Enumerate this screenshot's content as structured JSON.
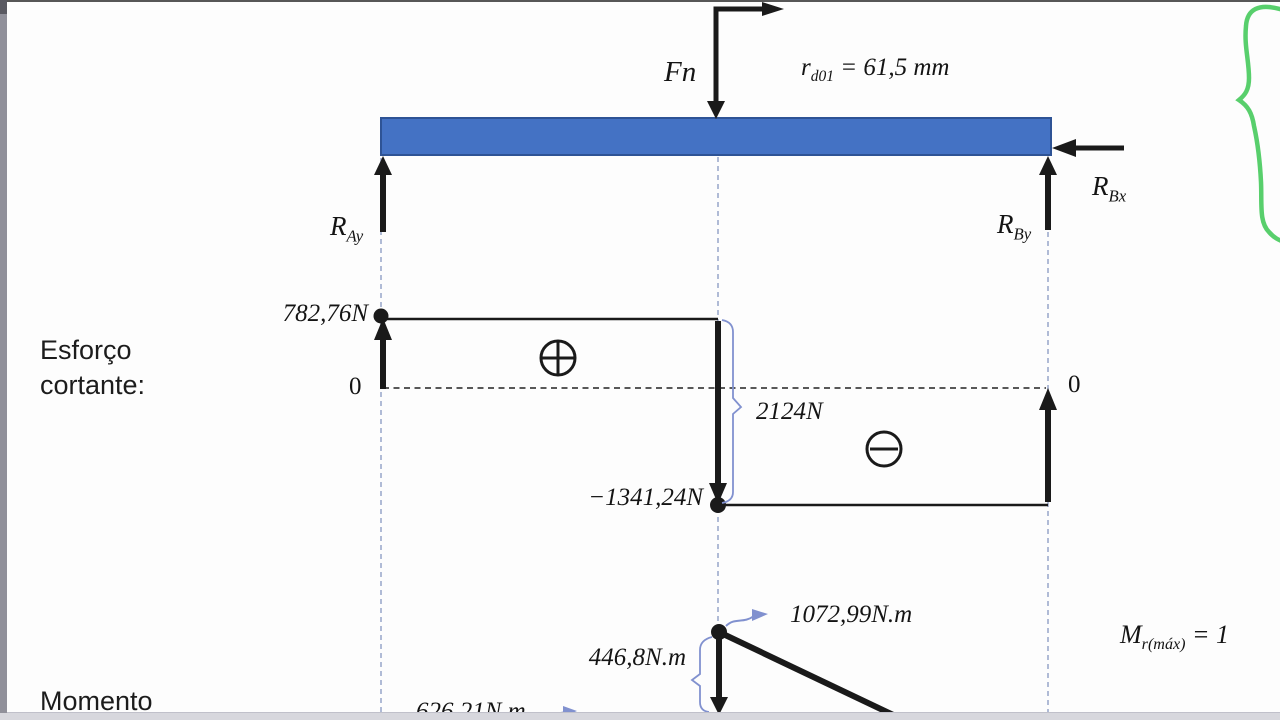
{
  "colors": {
    "beam_fill": "#4472C4",
    "beam_border": "#2E5395",
    "ink": "#1A1A1A",
    "annotation_blue": "#8191CF",
    "construction_dash": "#97A5C9",
    "brace_green": "#58CF6C",
    "side_bar_gray": "#90909A",
    "bottom_band_gray": "#D7D7DD"
  },
  "fbd": {
    "force_label": "Fn",
    "radius": {
      "base": "r",
      "sub": "d01",
      "rest": " = 61,5 mm"
    },
    "ray": {
      "base": "R",
      "sub": "Ay"
    },
    "rby": {
      "base": "R",
      "sub": "By"
    },
    "rbx": {
      "base": "R",
      "sub": "Bx"
    }
  },
  "shear": {
    "section_label": "Esforço\ncortante:",
    "max_value": "782,76N",
    "min_value": "−1341,24N",
    "jump_value": "2124N",
    "zero_left": "0",
    "zero_right": "0"
  },
  "moment": {
    "section_label": "Momento",
    "peak_value": "1072,99N.m",
    "left_value": "446,8N.m",
    "bottom_value": "626,21N.m",
    "max_formula": {
      "base": "M",
      "sub": "r(máx)",
      "rest": " = 1"
    }
  },
  "chart_data": [
    {
      "type": "area",
      "title": "Esforço cortante",
      "ylabel": "V (N)",
      "segments": [
        {
          "span": "A to load Fn",
          "value": 782.76,
          "sign": "+"
        },
        {
          "span": "load Fn to B",
          "value": -1341.24,
          "sign": "-"
        }
      ],
      "jump_at_load": 2124,
      "zero_axis_labels": [
        "0",
        "0"
      ],
      "grid": false,
      "annotations": [
        "⊕ positive region",
        "⊖ negative region"
      ]
    },
    {
      "type": "line",
      "title": "Momento",
      "ylabel": "M (N.m)",
      "labeled_values": [
        446.8,
        626.21,
        1072.99
      ],
      "notes_visible": [
        "peak 1072,99N.m at load point, descending line toward B"
      ]
    }
  ]
}
